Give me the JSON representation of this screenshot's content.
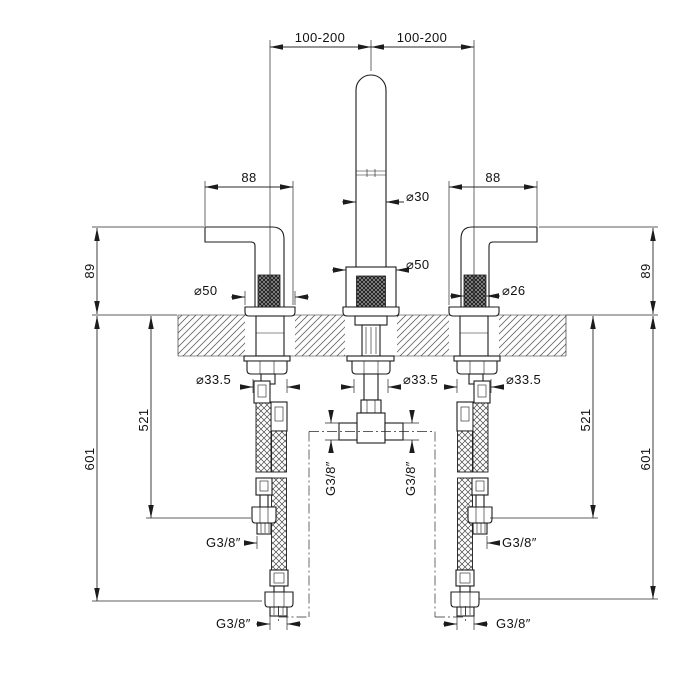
{
  "drawing": {
    "type": "faucet-installation-technical-drawing",
    "background_color": "#ffffff",
    "line_color": "#1c1c1c",
    "dims": {
      "top_spacing_left": "100-200",
      "top_spacing_right": "100-200",
      "handle_width_left": "88",
      "handle_width_right": "88",
      "spout_diameter": "⌀30",
      "spout_base_diameter": "⌀50",
      "left_handle_base_diameter": "⌀50",
      "right_handle_knurl_diameter": "⌀26",
      "height_above_deck_left": "89",
      "height_above_deck_right": "89",
      "hole_diameter_left": "⌀33.5",
      "hole_diameter_center": "⌀33.5",
      "hole_diameter_right": "⌀33.5",
      "hose_length_inner_left": "521",
      "hose_length_inner_right": "521",
      "hose_length_outer_left": "601",
      "hose_length_outer_right": "601",
      "thread_tee_left": "G3/8″",
      "thread_tee_right": "G3/8″",
      "thread_mid_left": "G3/8″",
      "thread_mid_right": "G3/8″",
      "thread_bottom_left": "G3/8″",
      "thread_bottom_right": "G3/8″"
    }
  }
}
